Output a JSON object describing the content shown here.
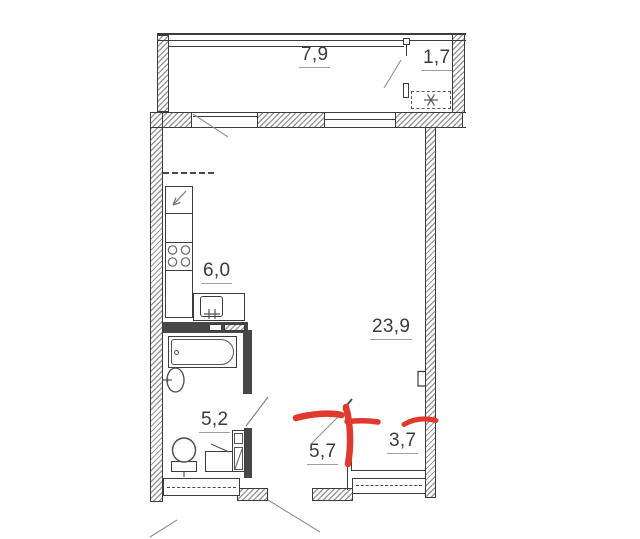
{
  "plan": {
    "kind": "apartment-floor-plan",
    "rooms": {
      "balcony": {
        "area": "7,9"
      },
      "balcony_section": {
        "area": "1,7"
      },
      "kitchen": {
        "area": "6,0"
      },
      "living_room": {
        "area": "23,9"
      },
      "bathroom": {
        "area": "5,2"
      },
      "hallway": {
        "area": "5,7"
      },
      "storage": {
        "area": "3,7"
      }
    },
    "fixtures": [
      "balcony-glazing",
      "air-conditioner",
      "kitchen-counter",
      "stove-burners",
      "kitchen-sink",
      "bathtub",
      "washbasin",
      "toilet",
      "washing-machine",
      "storage-cabinet",
      "ventilation-duct",
      "window",
      "balcony-door",
      "bathroom-door",
      "entrance-opening"
    ]
  },
  "colors": {
    "background": "#ffffff",
    "line": "#3c3c3c",
    "hatch": "#9a9a9a",
    "leader": "#909090",
    "text": "#3b3b3b",
    "annotation_red": "#e2392d"
  }
}
